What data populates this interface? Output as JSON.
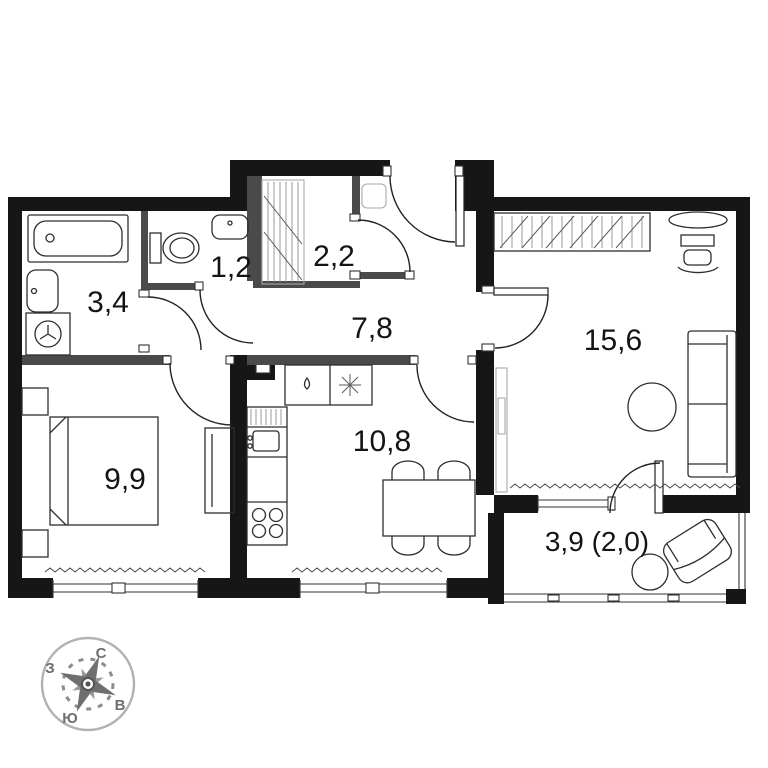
{
  "plan": {
    "rooms": [
      {
        "name": "bathroom",
        "area": "3,4"
      },
      {
        "name": "wc",
        "area": "1,2"
      },
      {
        "name": "closet",
        "area": "2,2"
      },
      {
        "name": "hallway",
        "area": "7,8"
      },
      {
        "name": "living-room",
        "area": "15,6"
      },
      {
        "name": "bedroom",
        "area": "9,9"
      },
      {
        "name": "kitchen",
        "area": "10,8"
      },
      {
        "name": "balcony",
        "area": "3,9 (2,0)"
      }
    ],
    "compass": {
      "north": "С",
      "south": "Ю",
      "west": "З",
      "east": "В"
    },
    "colors": {
      "wall": "#161616",
      "partition": "#4a4a4a",
      "furniture_line": "#2e2e2e",
      "compass_gray": "#8c8c8c"
    }
  }
}
